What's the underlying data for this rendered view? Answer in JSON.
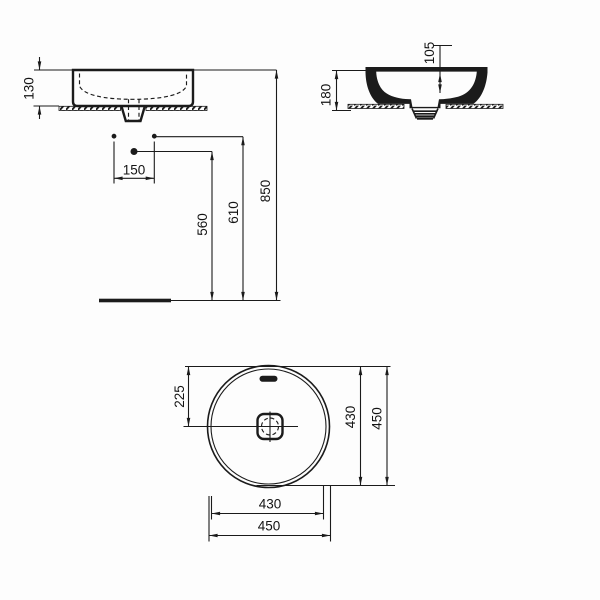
{
  "drawing": {
    "type": "washbasin-dimensional-drawing",
    "views": {
      "front": {
        "dims": {
          "rim_to_counter": "130",
          "tap_hole_spacing": "150",
          "drain_center_height": "560",
          "tap_hole_height": "610",
          "rim_height": "850"
        }
      },
      "side": {
        "dims": {
          "inner_depth": "105",
          "overall_height": "180"
        }
      },
      "plan": {
        "dims": {
          "center_from_edge": "225",
          "inner_diameter": "430",
          "outer_diameter": "450"
        }
      }
    },
    "colors": {
      "line": "#1b1b1b",
      "background": "#fdfdfd",
      "fill": "#ffffff"
    }
  }
}
